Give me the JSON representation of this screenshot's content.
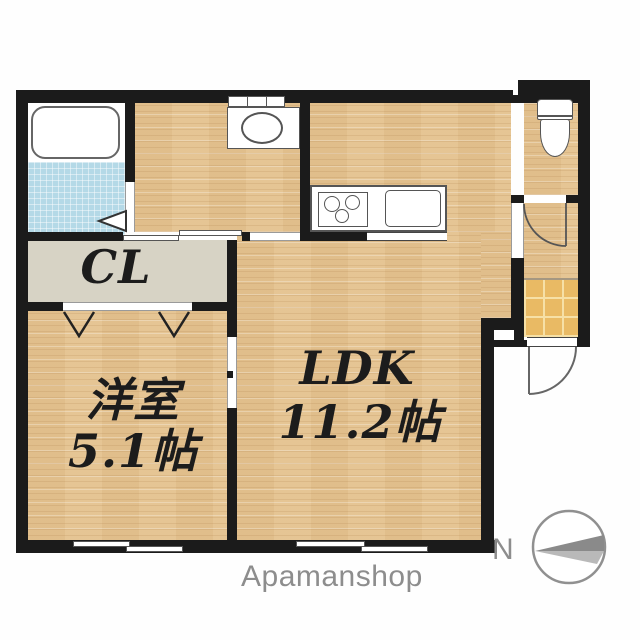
{
  "plan": {
    "rooms": {
      "ldk": {
        "label": "LDK",
        "size": "11.2帖"
      },
      "western": {
        "label": "洋室",
        "size": "5.1帖"
      },
      "closet": {
        "label": "CL"
      }
    },
    "compass": {
      "north": "N"
    },
    "brand": "Apamanshop",
    "fixtures": [
      "bathtub",
      "bathroom-folding-door",
      "washbasin",
      "washroom-window-shelf",
      "kitchen-stove",
      "kitchen-sink",
      "toilet",
      "toilet-door",
      "entrance-door",
      "sliding-doors",
      "closet-folding-doors",
      "sliding-windows"
    ],
    "colors": {
      "wall": "#1b1b1b",
      "wood_floor": "#e3c190",
      "entrance_tile": "#e9ba64",
      "bath_tile": "#b4d9e7",
      "closet_fill": "#d7d3c5",
      "label_text": "#1c1c1c",
      "brand_text": "#8d8d8d",
      "compass_dark": "#8a8a8a",
      "compass_light": "#b9b9b9"
    }
  }
}
